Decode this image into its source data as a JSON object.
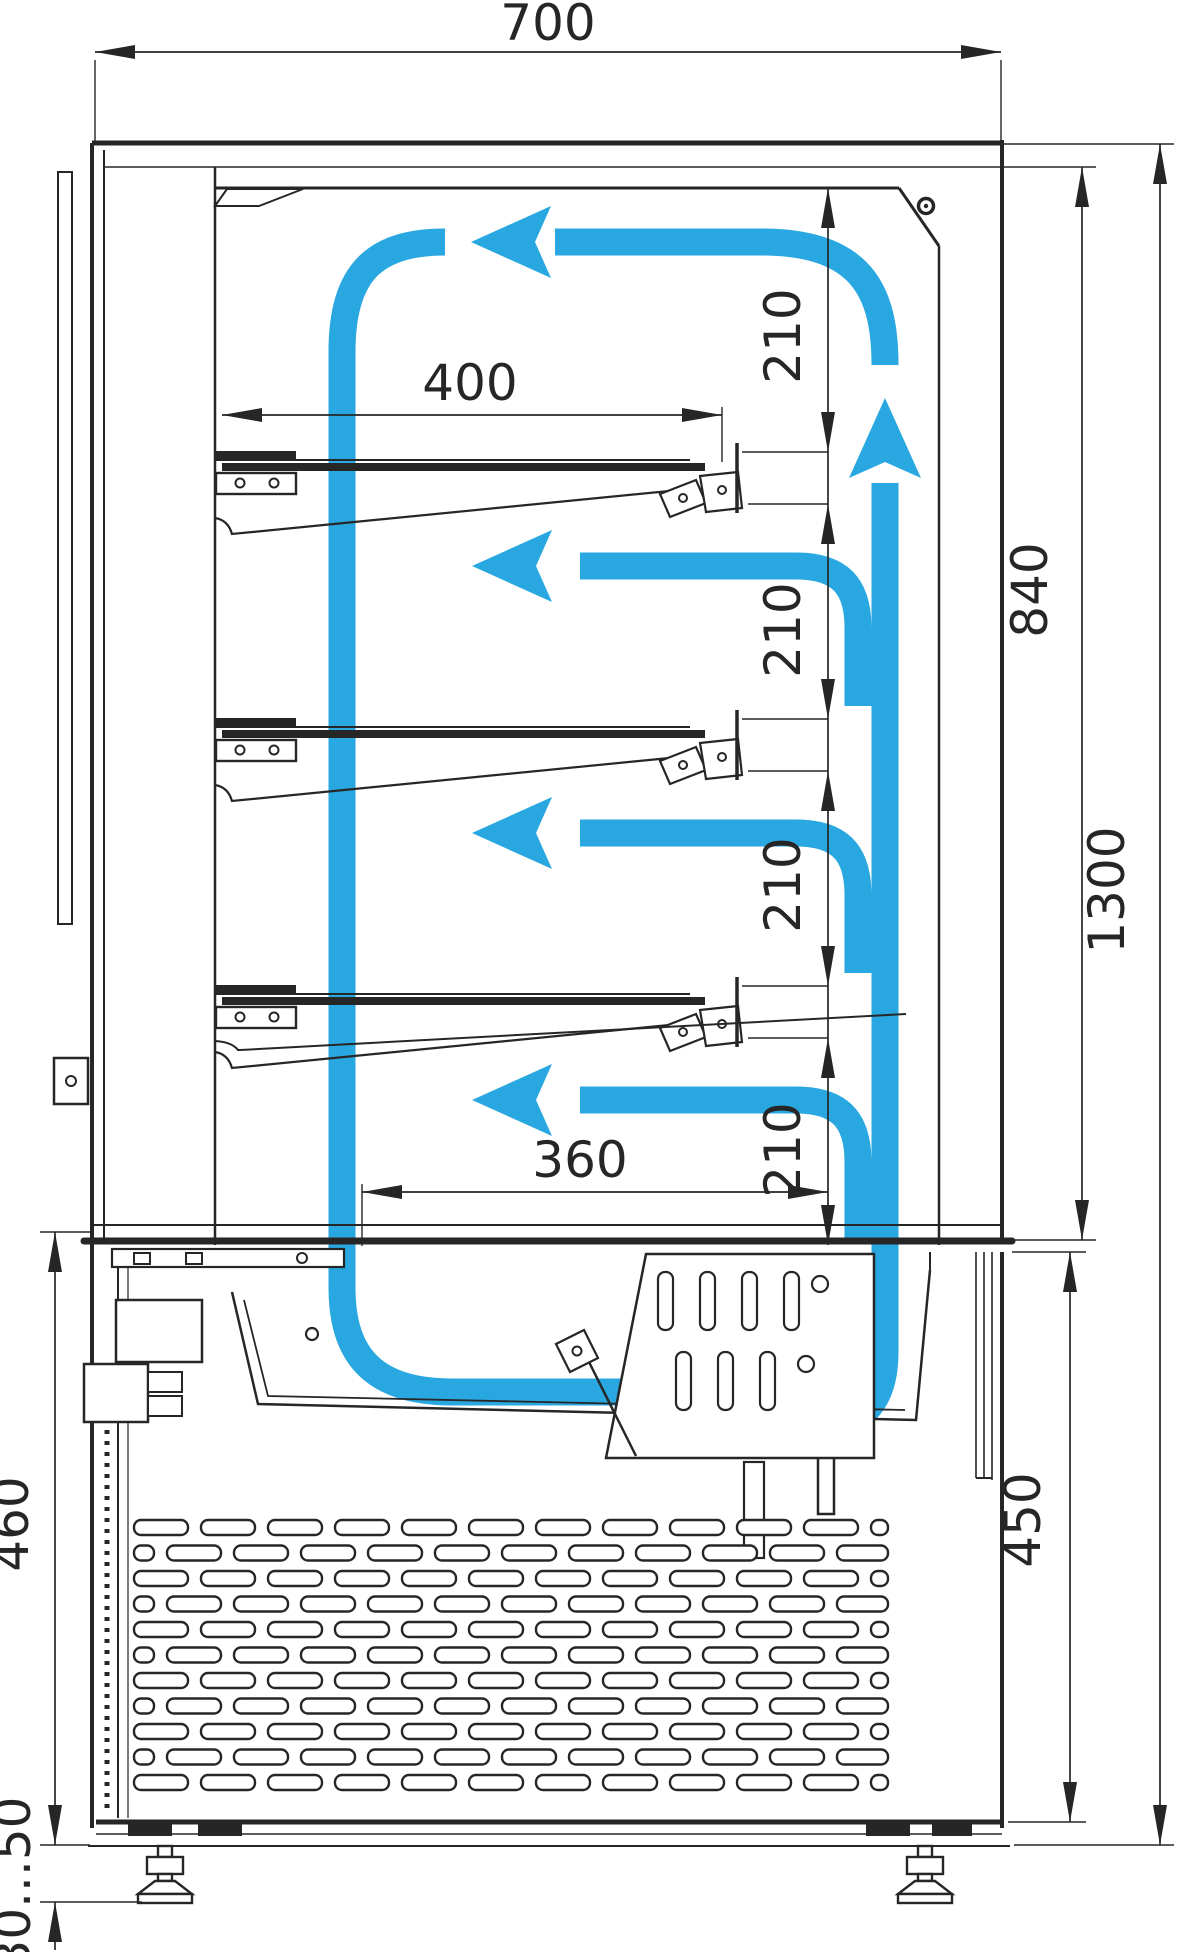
{
  "page": {
    "type": "technical-drawing",
    "subject": "Refrigerated display case cross-section with air circulation arrows",
    "units": "mm"
  },
  "colors": {
    "line": "#262626",
    "airflow": "#29a7e0",
    "background": "#ffffff"
  },
  "dims": {
    "width_overall": "700",
    "shelf_depth": "400",
    "well_depth": "360",
    "shelf_pitch": "210",
    "opening_height": "840",
    "glass_section_height": "1300",
    "base_height_left": "460",
    "base_height_right": "450",
    "foot_range": "30...50"
  }
}
